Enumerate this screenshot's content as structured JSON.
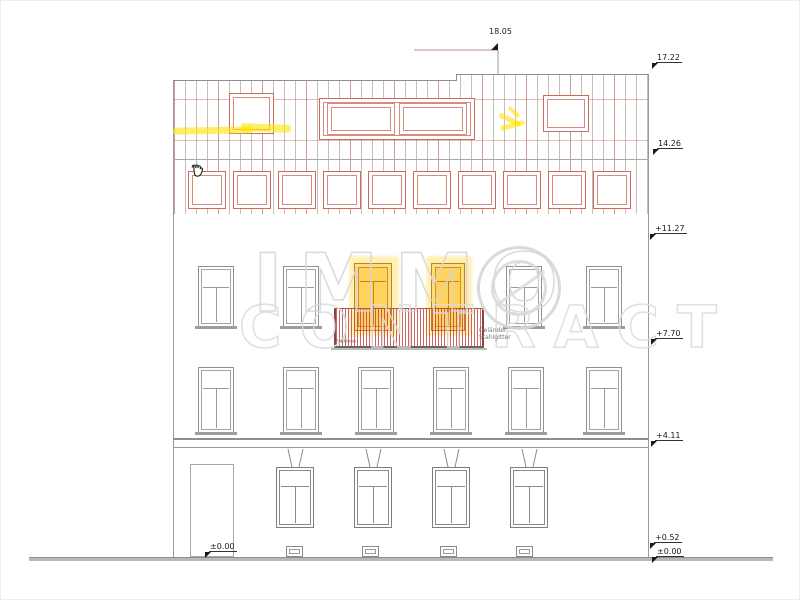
{
  "drawing": {
    "type": "building-front-elevation",
    "top_dimension": "18.05",
    "levels": [
      {
        "value": "17.22"
      },
      {
        "value": "14.26"
      },
      {
        "value": "+11.27"
      },
      {
        "value": "+7.70"
      },
      {
        "value": "+4.11"
      },
      {
        "value": "+0.52"
      },
      {
        "value": "±0.00"
      }
    ],
    "ground_label": "±0.00",
    "annotations": {
      "railing_line1": "Geländer",
      "railing_line2": "Stahlgitter",
      "door_note": "Falttüren"
    }
  },
  "watermark": {
    "brand": "IMMO CONTRACT",
    "line1": "IMMO",
    "line2": "CONTRACT"
  },
  "icons": {
    "cursor": "hand-cursor-icon"
  },
  "colors": {
    "highlight": "#ffe500",
    "roof_frame": "#cc6a5e",
    "railing": "#c24848",
    "door_frame": "#c08030",
    "door_fill": "#ffd246",
    "watermark": "#d6d6d6",
    "lines": "#9a9a9a",
    "ground": "#b8b8b8"
  }
}
